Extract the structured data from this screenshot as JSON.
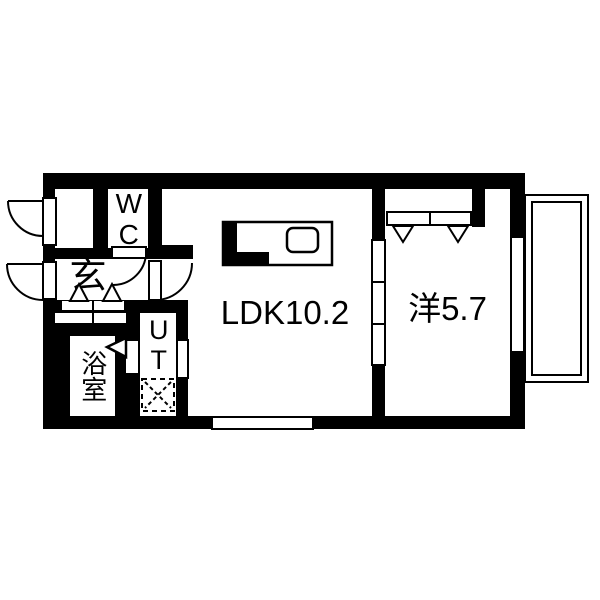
{
  "plan": {
    "rooms": {
      "wc": "WC",
      "entrance": "玄",
      "bathroom": "浴室",
      "utility": "UT",
      "ldk": "LDK10.2",
      "western_room": "洋5.7",
      "balcony": "バルコニー"
    },
    "colors": {
      "wall": "#000000",
      "floor": "#ffffff"
    }
  }
}
